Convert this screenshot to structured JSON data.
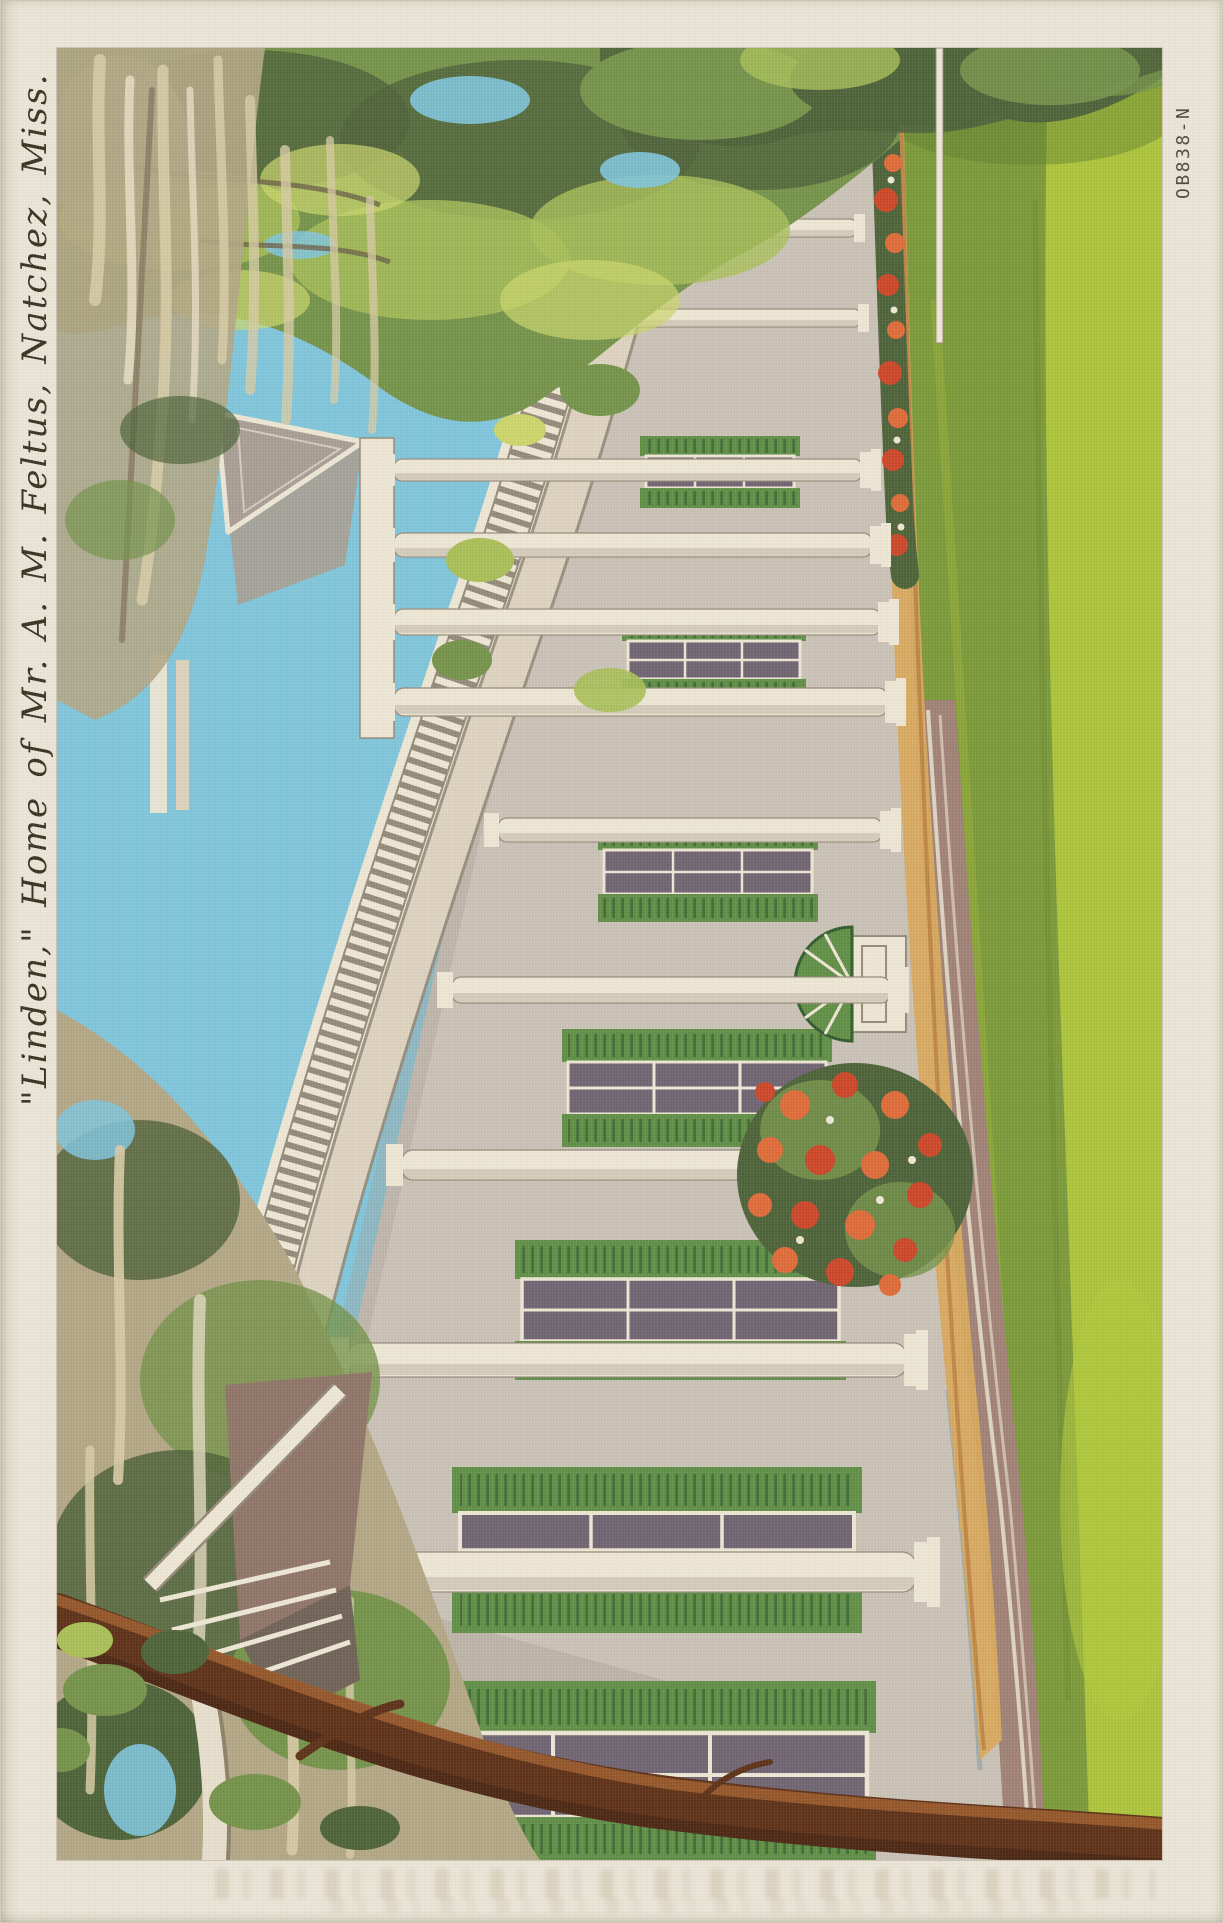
{
  "postcard": {
    "caption": "\"Linden,\" Home of Mr. A. M. Feltus, Natchez, Miss.",
    "stock_number": "OB838-N"
  },
  "colors": {
    "paper": "#ece7d9",
    "ink": "#38301f",
    "code_ink": "#4e463a",
    "sky": "#7fc6dd",
    "lawn": "#7a9a38",
    "lawn_bright": "#b1c93b",
    "lawn_dark": "#5e7c2d",
    "foliage_dark": "#4c6238",
    "foliage_mid": "#74934a",
    "foliage_light": "#a9c057",
    "foliage_yellow": "#ccd76b",
    "moss": "#d8cca6",
    "moss_shadow": "#b3a786",
    "wall": "#cbc3b8",
    "wall_shadow": "#a89e94",
    "cream": "#efe8d6",
    "trim_shadow": "#948a7a",
    "shutter": "#5f8f46",
    "shutter_dark": "#2f5a2b",
    "shutter_light": "#8db465",
    "glass": "#6e6372",
    "porch_tan": "#d9a95c",
    "steps_mauve": "#a08176",
    "flower_red": "#cc4527",
    "flower_orange": "#e06a38",
    "branch_dark": "#5c2f16",
    "branch_light": "#9c5c2c"
  }
}
